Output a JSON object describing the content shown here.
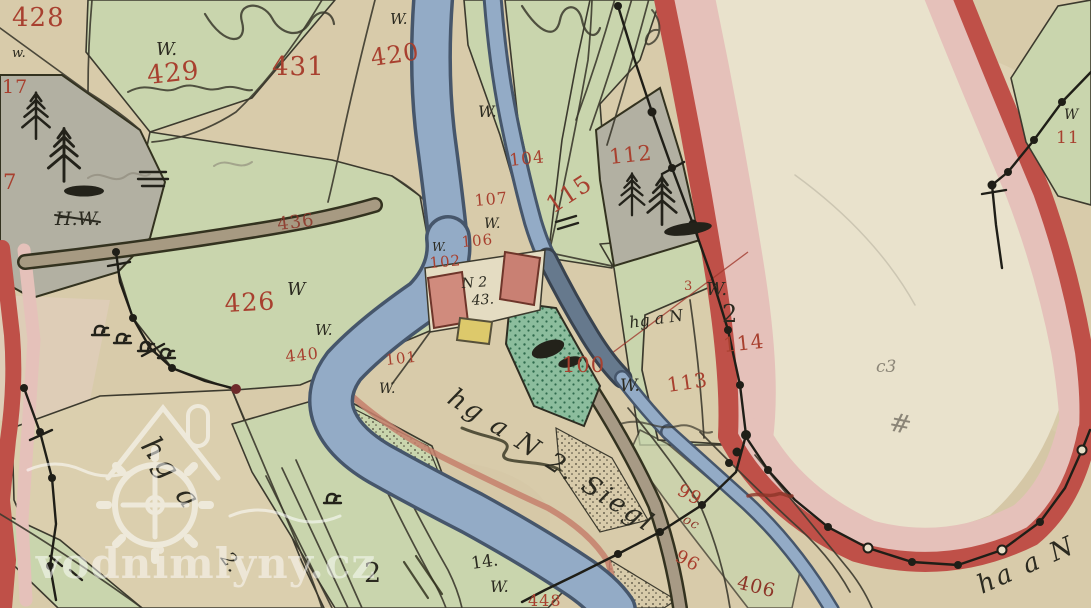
{
  "map": {
    "description": "hand-colored historical cadastral map scan",
    "watermark_text": "vodnimlyny.cz"
  },
  "palette": {
    "paper": "#d8cbaa",
    "paper_light": "#e9e2cc",
    "meadow_green": "#c9d5ad",
    "garden_green": "#8cbd9d",
    "forest_gray": "#b2b0a2",
    "river_blue": "#93abc6",
    "border_band_dark": "#bf5048",
    "border_band_light": "#e5c1ba",
    "building_pink": "#d08b7d",
    "building_yellow": "#ddc96b",
    "ink": "#2b2a20",
    "number_red": "#a8402f"
  },
  "parcel_numbers": [
    {
      "text": "428"
    },
    {
      "text": "429"
    },
    {
      "text": "431"
    },
    {
      "text": "420"
    },
    {
      "text": "104"
    },
    {
      "text": "112"
    },
    {
      "text": "107"
    },
    {
      "text": "115"
    },
    {
      "text": "106"
    },
    {
      "text": "102"
    },
    {
      "text": "100"
    },
    {
      "text": "113"
    },
    {
      "text": "114"
    },
    {
      "text": "3"
    },
    {
      "text": "426"
    },
    {
      "text": "440"
    },
    {
      "text": "101"
    },
    {
      "text": "436"
    },
    {
      "text": "99"
    },
    {
      "text": "96"
    },
    {
      "text": "406"
    },
    {
      "text": "11"
    },
    {
      "text": "17"
    },
    {
      "text": "7"
    },
    {
      "text": "448"
    }
  ],
  "letter_marks": [
    {
      "text": "W."
    },
    {
      "text": "W."
    },
    {
      "text": "W."
    },
    {
      "text": "W."
    },
    {
      "text": "W."
    },
    {
      "text": "W"
    },
    {
      "text": "W."
    },
    {
      "text": "W."
    },
    {
      "text": "W."
    },
    {
      "text": "W."
    },
    {
      "text": "w."
    },
    {
      "text": "W"
    },
    {
      "text": "W."
    },
    {
      "text": "H.W."
    },
    {
      "text": "2"
    },
    {
      "text": "14."
    },
    {
      "text": "2"
    },
    {
      "text": "N 2"
    },
    {
      "text": "43."
    }
  ],
  "script_notes": [
    {
      "text": "hg a N 2. Siegl"
    },
    {
      "text": "hg a"
    },
    {
      "text": "2."
    },
    {
      "text": "ha a N"
    },
    {
      "text": "hg a N"
    },
    {
      "text": "oc"
    }
  ],
  "pencil_notes": [
    {
      "text": "c3"
    },
    {
      "text": "#"
    }
  ]
}
